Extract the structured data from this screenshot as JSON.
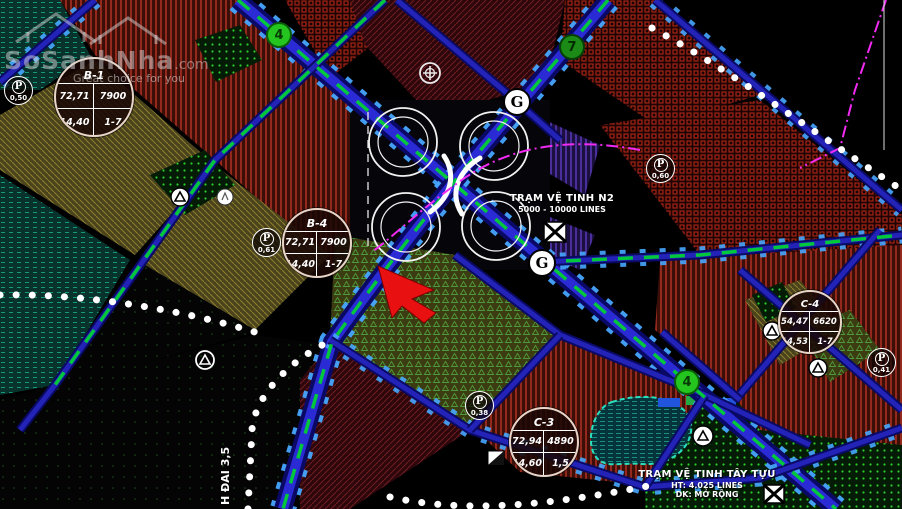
{
  "watermark": {
    "brand": "SoSanhNha",
    "suffix": ".com",
    "tagline": "Great choice for you"
  },
  "parcels": [
    {
      "name": "B-1",
      "area": "72,71",
      "population": "7900",
      "density": "14,40",
      "floors": "1-7"
    },
    {
      "name": "B-4",
      "area": "72,71",
      "population": "7900",
      "density": "14,40",
      "floors": "1-7"
    },
    {
      "name": "C-4",
      "area": "54,47",
      "population": "6620",
      "density": "14,53",
      "floors": "1-7"
    },
    {
      "name": "C-3",
      "area": "72,94",
      "population": "4890",
      "density": "14,60",
      "floors": "1,5"
    }
  ],
  "parking": [
    {
      "label": "P",
      "value": "0,50"
    },
    {
      "label": "P",
      "value": "0,61"
    },
    {
      "label": "P",
      "value": "0,60"
    },
    {
      "label": "P",
      "value": "0,38"
    },
    {
      "label": "P",
      "value": "0,41"
    }
  ],
  "road_badges": [
    {
      "number": "4"
    },
    {
      "number": "7"
    },
    {
      "number": "4"
    }
  ],
  "junction_markers": [
    {
      "label": "G"
    },
    {
      "label": "G"
    }
  ],
  "stations": {
    "n2": {
      "title": "TRẠM VỆ TINH N2",
      "capacity": "5000 - 10000 LINES"
    },
    "tay_tuu": {
      "title": "TRẠM VỆ TINH TÂY TỰU",
      "line2": "HT: 4.025 LINES",
      "line3": "DK: MỞ RỘNG"
    }
  },
  "road_label": {
    "text": "H ĐAI 3,5"
  },
  "colors": {
    "road_casing": "#0a0a66",
    "road_core": "#2b2bd6",
    "tick_blue": "#47a7ff",
    "transit_green": "#00c83c",
    "boundary_magenta": "#f22bf2",
    "marker_red": "#e81010",
    "badge_green": "#25c51f"
  }
}
